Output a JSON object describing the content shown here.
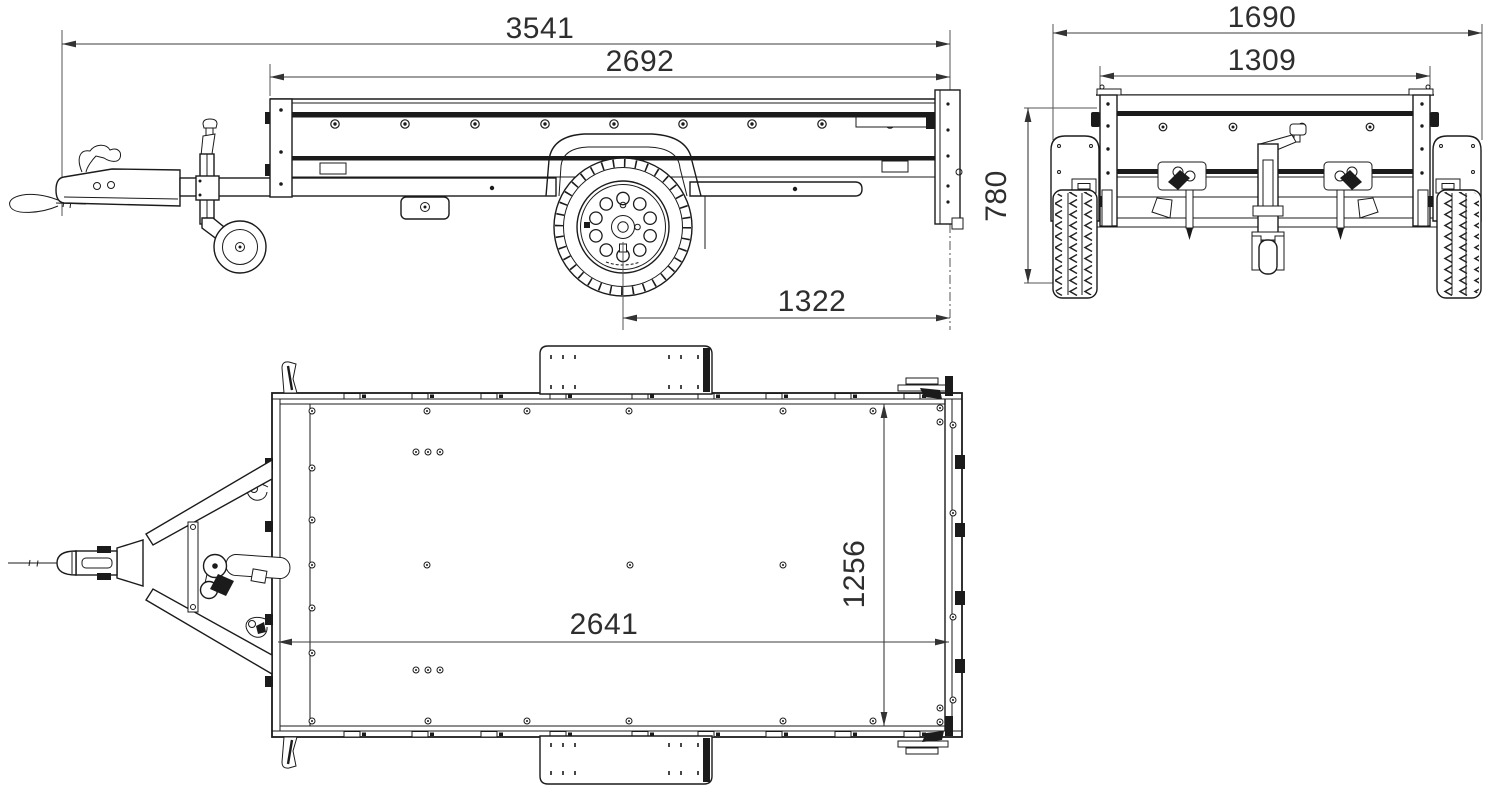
{
  "drawing": {
    "title": "Trailer technical drawing - three orthographic views",
    "units": "mm",
    "background_color": "#ffffff",
    "line_color": "#1b1b1b",
    "dim_text_color": "#2e2e2e",
    "views": {
      "side": {
        "name": "Side view",
        "dimensions": {
          "overall_length": "3541",
          "bed_length": "2692",
          "axle_to_rear": "1322"
        }
      },
      "rear": {
        "name": "Rear view",
        "dimensions": {
          "overall_width": "1690",
          "inner_width": "1309",
          "overall_height": "780"
        }
      },
      "top": {
        "name": "Top view",
        "dimensions": {
          "bed_inner_length": "2641",
          "bed_inner_width": "1256"
        }
      }
    }
  }
}
